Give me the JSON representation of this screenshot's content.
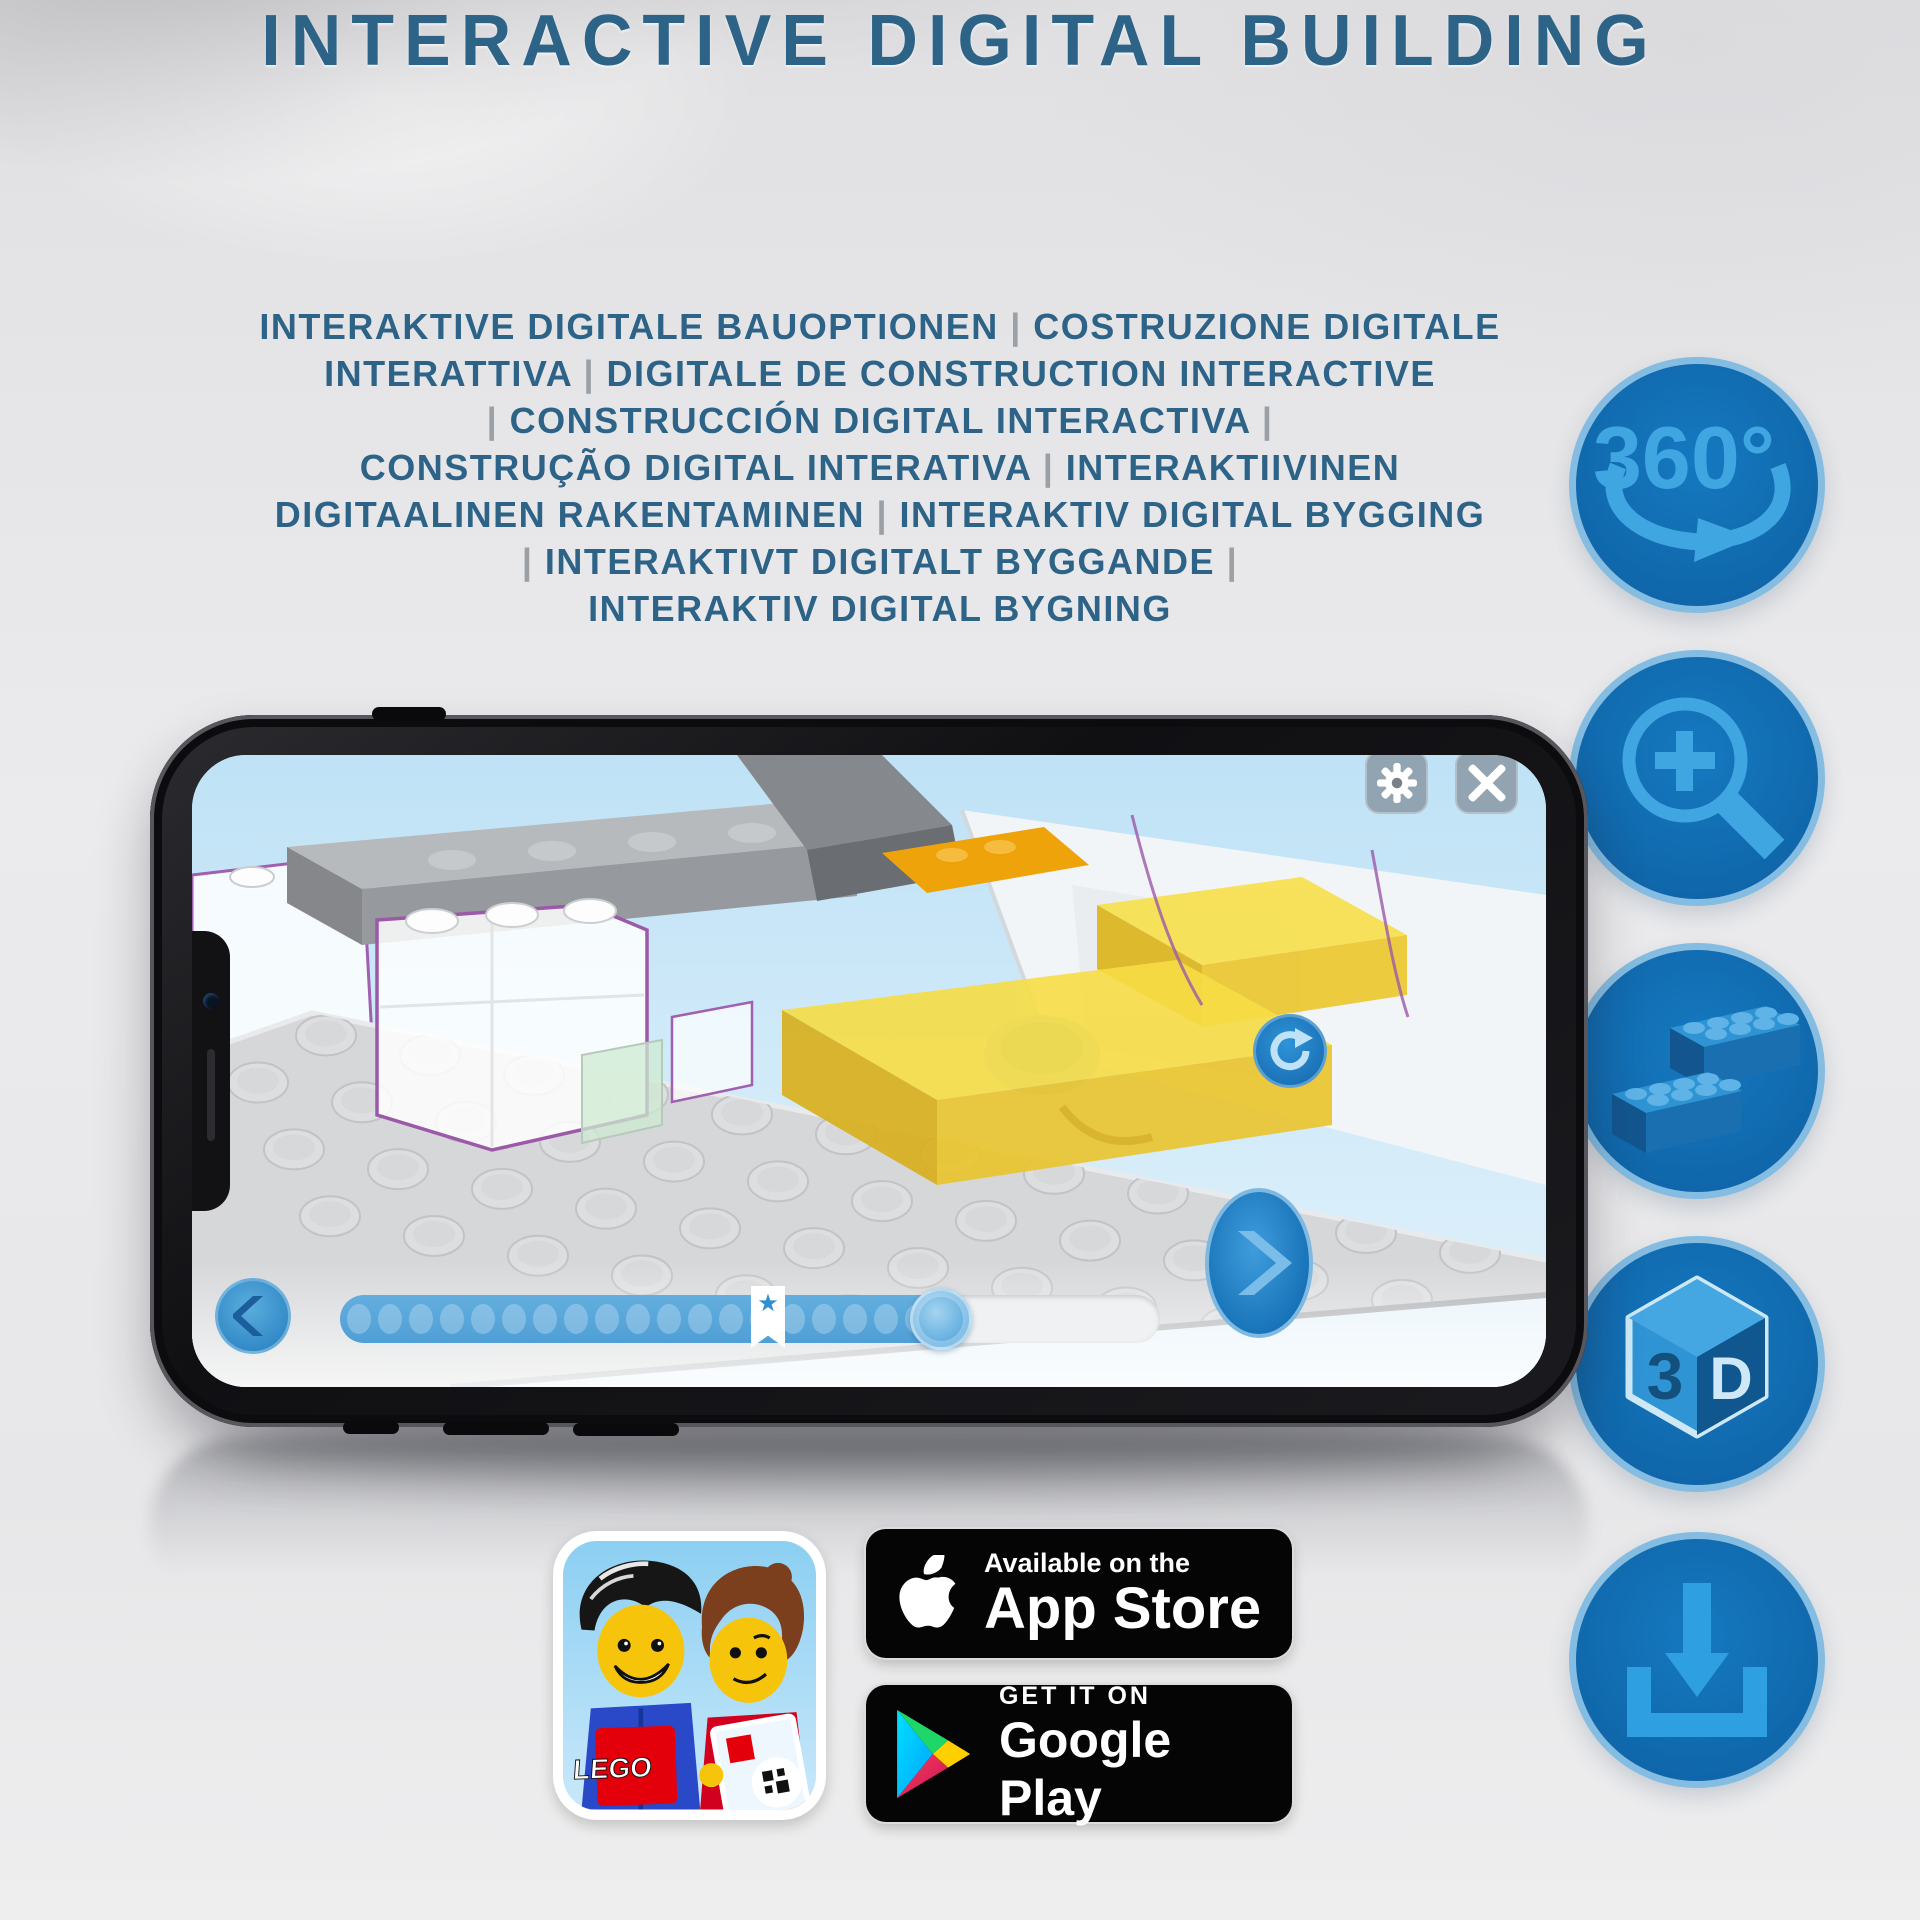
{
  "header": {
    "title": "INTERACTIVE DIGITAL BUILDING",
    "subtitle_lines": [
      "INTERAKTIVE DIGITALE BAUOPTIONEN | COSTRUZIONE DIGITALE",
      "INTERATTIVA | DIGITALE DE CONSTRUCTION INTERACTIVE",
      "| CONSTRUCCIÓN DIGITAL INTERACTIVA |",
      "CONSTRUÇÃO DIGITAL INTERATIVA | INTERAKTIIVINEN",
      "DIGITAALINEN RAKENTAMINEN | INTERAKTIV DIGITAL BYGGING",
      "| INTERAKTIVT DIGITALT BYGGANDE |",
      "INTERAKTIV DIGITAL BYGNING"
    ]
  },
  "feature_icons": [
    {
      "name": "360-rotation",
      "label": "360°"
    },
    {
      "name": "zoom-in"
    },
    {
      "name": "brick-steps"
    },
    {
      "name": "3d-view",
      "label_left": "3",
      "label_right": "D"
    },
    {
      "name": "download"
    }
  ],
  "phone": {
    "slider": {
      "dot_count": 19,
      "bookmark_star": "★"
    }
  },
  "badges": {
    "app_store": {
      "tagline": "Available on the",
      "store": "App Store"
    },
    "google_play": {
      "tagline": "GET IT ON",
      "store": "Google Play"
    },
    "lego_app": {
      "logo_text": "LEGO"
    }
  },
  "colors": {
    "title_blue": "#2e6388",
    "icon_circle_fill": "#1174ba",
    "icon_circle_ring": "#84bce2",
    "icon_glyph": "#3ba4e2",
    "app_ui_blue": "#57a8dd"
  }
}
